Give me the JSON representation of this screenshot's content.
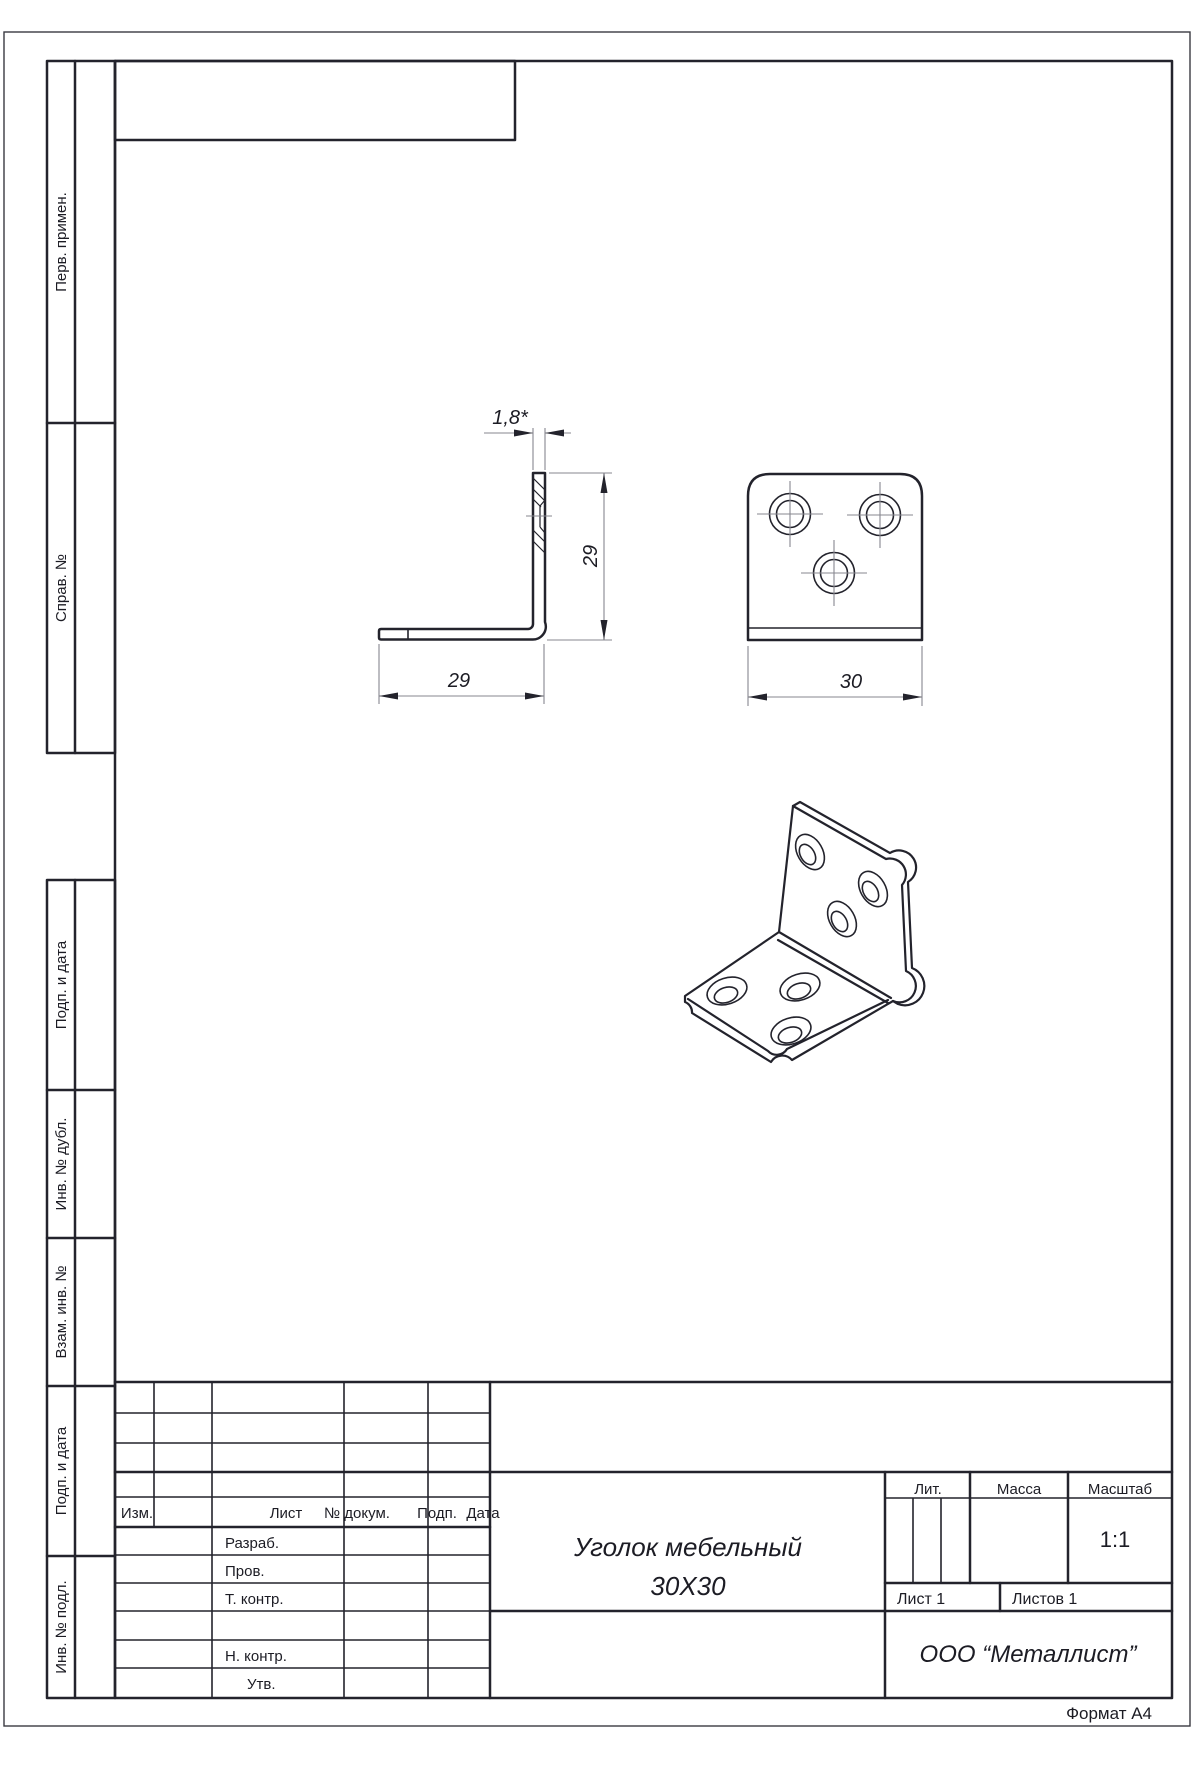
{
  "sheet": {
    "format_note": "Формат А4"
  },
  "margin_labels": {
    "perv_primen": "Перв. примен.",
    "sprav_no": "Справ. №",
    "podp_i_data_1": "Подп. и дата",
    "inv_no_dubl": "Инв. № дубл.",
    "vzam_inv_no": "Взам. инв. №",
    "podp_i_data_2": "Подп. и дата",
    "inv_no_podl": "Инв. № подл."
  },
  "title_block": {
    "headers": {
      "izm": "Изм.",
      "list": "Лист",
      "no_dokum": "№ докум.",
      "podp": "Подп.",
      "data": "Дата"
    },
    "roles": {
      "razrab": "Разраб.",
      "prov": "Пров.",
      "t_kontr": "Т. контр.",
      "n_kontr": "Н. контр.",
      "utv": "Утв."
    },
    "title_line1": "Уголок мебельный",
    "title_line2": "30Х30",
    "lit_label": "Лит.",
    "massa_label": "Масса",
    "masshtab_label": "Масштаб",
    "scale_value": "1:1",
    "sheet_info": "Лист 1",
    "sheets_info": "Листов 1",
    "company": "ООО “Металлист”"
  },
  "dimensions": {
    "thickness": "1,8*",
    "height": "29",
    "length": "29",
    "width": "30"
  }
}
